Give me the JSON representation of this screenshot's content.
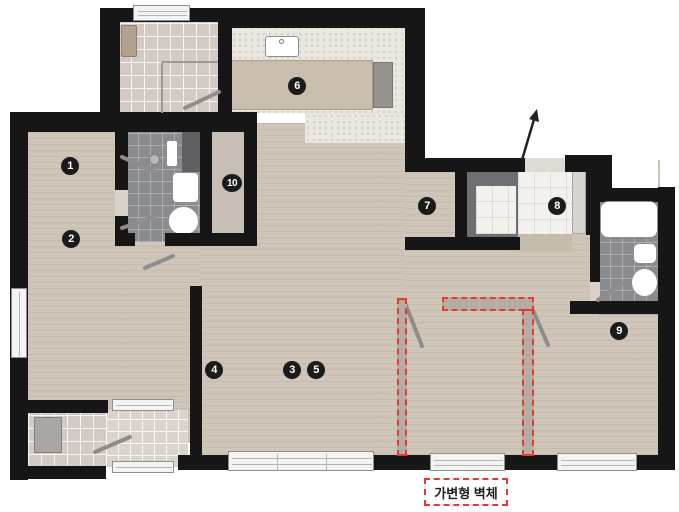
{
  "floorplan": {
    "legend_label": "가변형 벽체",
    "markers": [
      {
        "label": "1"
      },
      {
        "label": "2"
      },
      {
        "label": "3"
      },
      {
        "label": "4"
      },
      {
        "label": "5"
      },
      {
        "label": "6"
      },
      {
        "label": "7"
      },
      {
        "label": "8"
      },
      {
        "label": "9"
      },
      {
        "label": "10"
      }
    ],
    "colors": {
      "wall": "#161616",
      "wood_floor": "#cfc5b8",
      "accent_red": "#e03c31"
    }
  }
}
